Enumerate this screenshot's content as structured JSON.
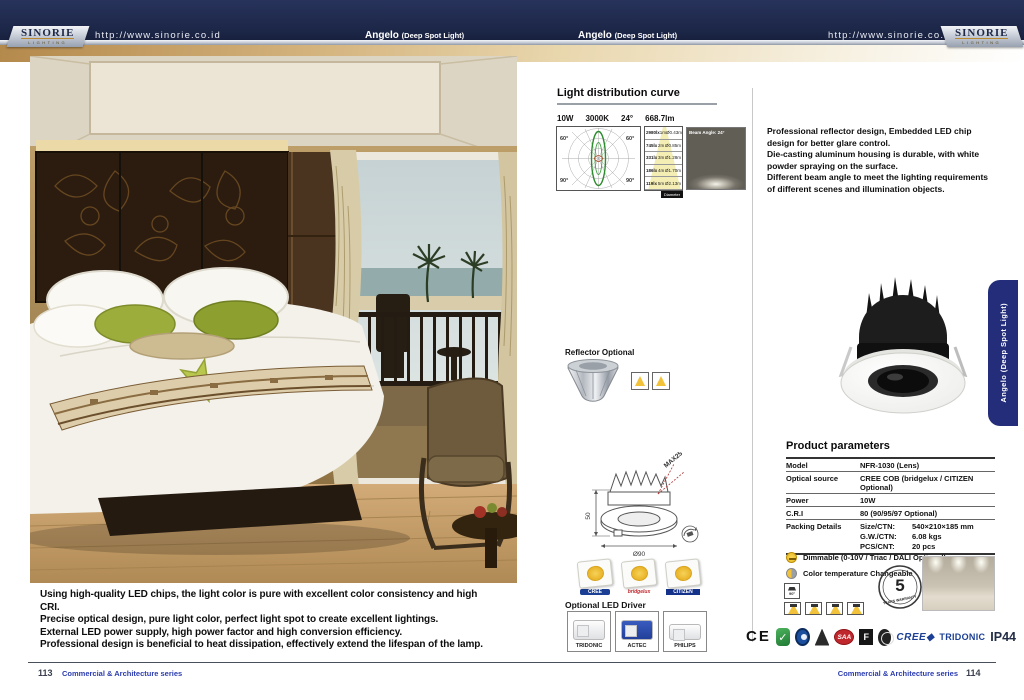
{
  "header": {
    "brand": "SINORIE",
    "brand_sub": "LIGHTING",
    "url": "http://www.sinorie.co.id",
    "product_name": "Angelo",
    "product_sub": "(Deep Spot Light)"
  },
  "side_tab": {
    "label": "Angelo (Deep Spot Light)"
  },
  "left_page": {
    "features": [
      "Using high-quality LED chips, the light color is pure with excellent color consistency and high CRI.",
      "Precise optical design, pure light color, perfect light spot to create excellent lightings.",
      "External LED power supply, high power factor and high conversion efficiency.",
      "Professional design is beneficial to heat dissipation, effectively extend the lifespan of the lamp."
    ]
  },
  "distribution": {
    "title": "Light distribution curve",
    "specs": [
      "10W",
      "3000K",
      "24°",
      "668.7lm"
    ],
    "polar_labels": {
      "tl": "60°",
      "tr": "60°",
      "bl": "90°",
      "br": "90°"
    },
    "cone_rows": [
      {
        "lux": "2980lx",
        "dist": "1m",
        "dia": "Ø0.43m"
      },
      {
        "lux": "745lx",
        "dist": "2m",
        "dia": "Ø0.85m"
      },
      {
        "lux": "331lx",
        "dist": "3m",
        "dia": "Ø1.28m"
      },
      {
        "lux": "186lx",
        "dist": "4m",
        "dia": "Ø1.70m"
      },
      {
        "lux": "119lx",
        "dist": "5m",
        "dia": "Ø2.13m"
      }
    ],
    "cone_tag": "Diameter",
    "beam_label": "Beam Angle: 24°"
  },
  "reflector": {
    "label": "Reflector Optional"
  },
  "dimensions": {
    "tilt": "MAX25°",
    "height": "50",
    "diameter": "Ø90"
  },
  "chips": {
    "items": [
      {
        "name": "CREE"
      },
      {
        "name": "bridgelux"
      },
      {
        "name": "CITIZEN"
      }
    ]
  },
  "drivers": {
    "title": "Optional LED Driver",
    "items": [
      "TRIDONIC",
      "ACTEC",
      "PHILIPS"
    ]
  },
  "description": {
    "lines": [
      "Professional reflector design, Embedded LED chip design for better glare control.",
      "Die-casting aluminum housing is durable, with white powder spraying on the surface.",
      "Different beam angle to meet the lighting requirements of different scenes and illumination objects."
    ]
  },
  "parameters": {
    "title": "Product parameters",
    "rows": [
      {
        "label": "Model",
        "value": "NFR-1030  (Lens)"
      },
      {
        "label": "Optical source",
        "value": "CREE COB (bridgelux / CITIZEN Optional)"
      },
      {
        "label": "Power",
        "value": "10W"
      },
      {
        "label": "C.R.I",
        "value": "80 (90/95/97 Optional)"
      }
    ],
    "packing": {
      "label": "Packing Details",
      "rows": [
        {
          "k": "Size/CTN:",
          "v": "540×210×185 mm"
        },
        {
          "k": "G.W./CTN:",
          "v": "6.08 kgs"
        },
        {
          "k": "PCS/CNT:",
          "v": "20 pcs"
        }
      ]
    },
    "dimmable": "Dimmable (0-10V / Triac / DALI Optional)",
    "cct": "Color temperature Changeable",
    "tilt_icon": "90°",
    "warranty_number": "5",
    "warranty_text": "YEARS WARRANTY"
  },
  "certifications": {
    "ce": "CE",
    "saa": "SAA",
    "f": "F",
    "cree": "CREE◆",
    "tridonic": "TRIDONIC",
    "ip": "IP44"
  },
  "footer": {
    "left_num": "113",
    "series": "Commercial & Architecture series",
    "right_num": "114"
  },
  "colors": {
    "navy": "#1f2950",
    "gold": "#c9a467",
    "accent_blue": "#2b3cae",
    "green_curve": "#2e8b2e",
    "yellow": "#f2c23a"
  }
}
